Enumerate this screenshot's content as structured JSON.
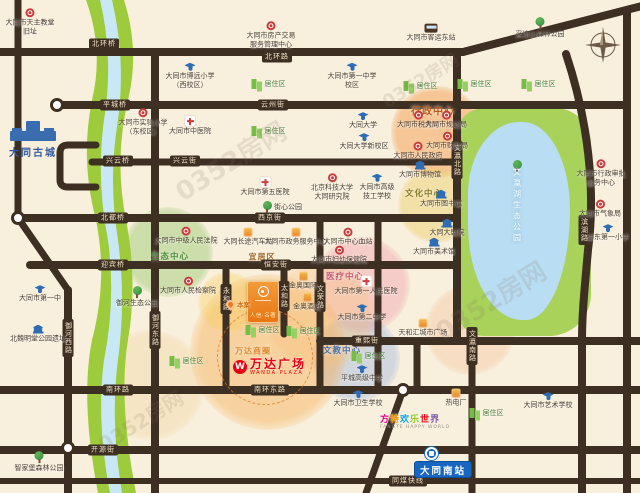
{
  "watermark": {
    "text": "0352房网"
  },
  "colors": {
    "road": "#3e2f23",
    "river_bank": "#9dcb3b",
    "river_water": "#c8e8f5",
    "lake_green": "#a9d25a",
    "lake_water": "#b9ddf2",
    "wanda_red": "#e60012",
    "station_blue": "#1766c2",
    "project_orange": "#e87613"
  },
  "landmarks": {
    "gucheng": {
      "name": "大同古城"
    },
    "wanda": {
      "logo": "W",
      "name": "万达广场",
      "sub": "WANDA PLAZA"
    },
    "fangte": {
      "chars": [
        [
          "方",
          "#e6007e"
        ],
        [
          "特",
          "#f39800"
        ],
        [
          "欢",
          "#00a0e9"
        ],
        [
          "乐",
          "#8fc31f"
        ],
        [
          "世",
          "#e60012"
        ],
        [
          "界",
          "#7b5aa6"
        ]
      ],
      "sub": "FANGTE HAPPY WORLD"
    },
    "station": {
      "name": "大同南站"
    },
    "project": {
      "name": "人信·名著",
      "marker": "本案"
    },
    "lake": {
      "name": "文瀛湖生态公园"
    }
  },
  "roads": {
    "segments": [
      [
        "M0,52 L463,52",
        8
      ],
      [
        "M463,52 L642,6",
        8
      ],
      [
        "M55,105 L627,105",
        8
      ],
      [
        "M92,162 L457,162",
        7
      ],
      [
        "M96,145 L68,145 Q60,145 60,153 L60,180 Q60,187 68,187 L96,187",
        7
      ],
      [
        "M18,218 L457,218",
        8
      ],
      [
        "M30,265 L457,265",
        8
      ],
      [
        "M320,341 L640,341",
        8
      ],
      [
        "M0,390 L640,390",
        8
      ],
      [
        "M0,450 L640,450",
        8
      ],
      [
        "M0,481 L640,481",
        6
      ],
      [
        "M18,0 L18,218",
        7
      ],
      [
        "M18,218 L68,290",
        7
      ],
      [
        "M68,290 L68,493",
        8
      ],
      [
        "M155,52 L155,493",
        8
      ],
      [
        "M226,265 L226,390",
        7
      ],
      [
        "M284,265 L284,334",
        7
      ],
      [
        "M320,218 L320,390",
        7
      ],
      [
        "M378,218 L378,390",
        7
      ],
      [
        "M417,341 L417,390",
        7
      ],
      [
        "M457,52 L457,341",
        8
      ],
      [
        "M472,341 L472,493",
        7
      ],
      [
        "M566,54 C588,120 596,190 588,250 C584,295 582,315 582,341 L582,493",
        8
      ],
      [
        "M627,10 L627,493",
        8
      ],
      [
        "M403,390 L366,493",
        7
      ]
    ],
    "nodes": [
      [
        57,
        105
      ],
      [
        18,
        218
      ],
      [
        68,
        448
      ],
      [
        403,
        390
      ]
    ]
  },
  "road_labels": [
    [
      "北环桥",
      104,
      44,
      0
    ],
    [
      "北环路",
      277,
      57,
      0
    ],
    [
      "平城桥",
      115,
      105,
      0
    ],
    [
      "云州街",
      273,
      105,
      0
    ],
    [
      "兴云桥",
      118,
      161,
      0
    ],
    [
      "兴云街",
      185,
      161,
      0
    ],
    [
      "北都桥",
      113,
      218,
      0
    ],
    [
      "西京街",
      270,
      218,
      0
    ],
    [
      "迎宾桥",
      113,
      265,
      0
    ],
    [
      "恒安街",
      276,
      265,
      0
    ],
    [
      "重熙街",
      367,
      341,
      0
    ],
    [
      "南环路",
      118,
      390,
      0
    ],
    [
      "南环东路",
      270,
      390,
      0
    ],
    [
      "开源街",
      103,
      450,
      0
    ],
    [
      "同煤快线",
      408,
      481,
      0
    ],
    [
      "御河西路",
      68,
      338,
      1
    ],
    [
      "御河东路",
      155,
      330,
      1
    ],
    [
      "永和路",
      226,
      299,
      1
    ],
    [
      "太和路",
      284,
      296,
      1
    ],
    [
      "文荣路",
      320,
      297,
      1
    ],
    [
      "文瀛北路",
      457,
      160,
      1
    ],
    [
      "文瀛南路",
      472,
      346,
      1
    ],
    [
      "滨湖路",
      584,
      230,
      1
    ]
  ],
  "zones": [
    [
      168,
      252,
      45,
      "rgba(150,200,110,0.45)"
    ],
    [
      437,
      132,
      46,
      "rgba(243,158,80,0.5)"
    ],
    [
      436,
      205,
      38,
      "rgba(235,205,100,0.45)"
    ],
    [
      362,
      285,
      48,
      "rgba(240,140,160,0.35)"
    ],
    [
      356,
      358,
      44,
      "rgba(140,170,225,0.35)"
    ],
    [
      268,
      352,
      78,
      "rgba(246,166,66,0.4)"
    ],
    [
      320,
      315,
      55,
      "rgba(247,190,120,0.35)"
    ],
    [
      150,
      385,
      55,
      "rgba(242,205,140,0.3)"
    ],
    [
      470,
      330,
      45,
      "rgba(244,180,130,0.3)"
    ],
    [
      228,
      302,
      30,
      "rgba(250,205,80,0.35)"
    ]
  ],
  "zone_labels": [
    [
      "行政中心",
      433,
      110,
      "#b85a1a",
      10
    ],
    [
      "文化中心",
      424,
      193,
      "#8a7a28",
      8.5
    ],
    [
      "生态中心",
      170,
      256,
      "#4e8c3a",
      8.5
    ],
    [
      "医疗中心",
      345,
      276,
      "#c25b77",
      8.5
    ],
    [
      "文教中心",
      342,
      350,
      "#4a6fa5",
      8.5
    ],
    [
      "万达商圈",
      253,
      351,
      "#e08a2e",
      8
    ],
    [
      "宜居区",
      262,
      257,
      "#a06a28",
      8
    ]
  ],
  "pois": [
    [
      "gov",
      30,
      22,
      "大同市天主教堂\n旧址"
    ],
    [
      "gov",
      271,
      35,
      "大同市房产交易\n服务管理中心"
    ],
    [
      "gov",
      143,
      122,
      "大同市实验小学\n（东校区）"
    ],
    [
      "gov",
      186,
      236,
      "大同市中级人民法院"
    ],
    [
      "gov",
      188,
      286,
      "大同市人民检察院"
    ],
    [
      "gov",
      332,
      187,
      "北京科技大学\n大同研究院"
    ],
    [
      "gov",
      348,
      237,
      "大同市中心血站"
    ],
    [
      "gov",
      339,
      255,
      "大同市妇幼保健院"
    ],
    [
      "gov",
      418,
      120,
      "大同市税务局"
    ],
    [
      "gov",
      446,
      120,
      "大同市规划局"
    ],
    [
      "gov",
      447,
      141,
      "大同市财政局"
    ],
    [
      "gov",
      418,
      151,
      "大同市人民政府"
    ],
    [
      "gov",
      601,
      173,
      "大同市行政审批\n服务中心"
    ],
    [
      "gov",
      600,
      209,
      "大同市气象局"
    ],
    [
      "school",
      190,
      76,
      "大同市博远小学\n（西校区）"
    ],
    [
      "school",
      352,
      76,
      "大同市第一中学\n校区"
    ],
    [
      "school",
      363,
      121,
      "大同大学"
    ],
    [
      "school",
      364,
      142,
      "大同大学新校区"
    ],
    [
      "school",
      377,
      187,
      "大同市高级\n技工学校"
    ],
    [
      "school",
      362,
      313,
      "大同市第二中学"
    ],
    [
      "school",
      40,
      294,
      "大同市第一中"
    ],
    [
      "school",
      362,
      374,
      "平城高级中学"
    ],
    [
      "school",
      358,
      399,
      "大同市卫生学校"
    ],
    [
      "school",
      548,
      401,
      "大同市艺术学校"
    ],
    [
      "school",
      608,
      233,
      "御东第一小学"
    ],
    [
      "hosp",
      190,
      126,
      "大同市中医院"
    ],
    [
      "hosp",
      265,
      187,
      "大同市第五医院"
    ],
    [
      "hosp",
      366,
      286,
      "大同市第一人民医院"
    ],
    [
      "tree",
      540,
      28,
      "采凉山森林公园"
    ],
    [
      "tree",
      137,
      297,
      "御河生态公园"
    ],
    [
      "tree",
      39,
      462,
      "智家堡森林公园"
    ],
    [
      "tree",
      282,
      207,
      "街心公园",
      "inline"
    ],
    [
      "house",
      268,
      84,
      "居住区",
      "inline"
    ],
    [
      "house",
      420,
      86,
      "居住区",
      "inline"
    ],
    [
      "house",
      474,
      84,
      "居住区",
      "inline"
    ],
    [
      "house",
      538,
      84,
      "居住区",
      "inline"
    ],
    [
      "house",
      268,
      131,
      "居住区",
      "inline"
    ],
    [
      "house",
      262,
      330,
      "居住区",
      "inline"
    ],
    [
      "house",
      303,
      331,
      "居住区",
      "inline"
    ],
    [
      "house",
      186,
      361,
      "居住区",
      "inline"
    ],
    [
      "house",
      486,
      413,
      "居住区",
      "inline"
    ],
    [
      "house",
      368,
      356,
      "居住区",
      "inline"
    ],
    [
      "shop",
      248,
      237,
      "大同长途汽车站"
    ],
    [
      "shop",
      296,
      237,
      "大同市政务服务中心"
    ],
    [
      "shop",
      423,
      328,
      "天和汇城市广场"
    ],
    [
      "shop",
      303,
      281,
      "金奥国际"
    ],
    [
      "shop",
      307,
      302,
      "金奥酒店"
    ],
    [
      "factory",
      456,
      398,
      "热电厂"
    ],
    [
      "bus",
      431,
      33,
      "大同市客运东站"
    ],
    [
      "museum",
      420,
      170,
      "大同市博物馆"
    ],
    [
      "museum",
      441,
      199,
      "大同市图书馆"
    ],
    [
      "museum",
      447,
      228,
      "大同大剧院"
    ],
    [
      "museum",
      434,
      247,
      "大同市美术馆"
    ],
    [
      "museum",
      38,
      334,
      "北魏明堂公园遗址"
    ]
  ],
  "watermarks": [
    [
      230,
      160,
      26
    ],
    [
      490,
      300,
      26
    ],
    [
      420,
      80,
      18
    ],
    [
      140,
      420,
      20
    ]
  ]
}
